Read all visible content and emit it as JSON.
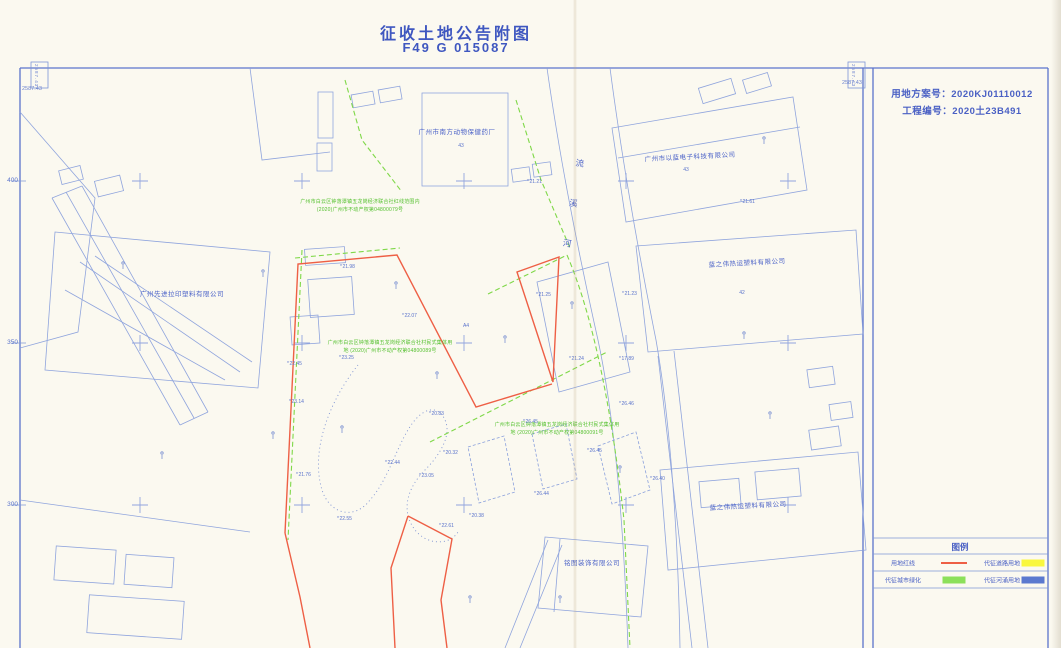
{
  "page": {
    "title_line1": "征收土地公告附图",
    "title_line2": "F49 G 015087"
  },
  "info_panel": {
    "line1": "用地方案号：2020KJ01110012",
    "line2": "工程编号：2020土23B491"
  },
  "legend": {
    "title": "图例",
    "items": [
      {
        "label": "用地红线",
        "symbol": "red-line",
        "color": "#ee5f45"
      },
      {
        "label": "代征道路用地",
        "symbol": "yellow-box",
        "color": "#f9f73e"
      },
      {
        "label": "代征城市绿化",
        "symbol": "green-box",
        "color": "#8ce05a"
      },
      {
        "label": "代征河涌用地",
        "symbol": "blue-box",
        "color": "#5b79cf"
      }
    ]
  },
  "frame": {
    "corner_coord_top_left": "2587.43",
    "corner_coord_top_right": "2587.43",
    "strip_left": "2587.43",
    "strip_right": "2587.43",
    "axis_labels": [
      "400",
      "350",
      "300"
    ]
  },
  "map": {
    "river_name": "流溪河",
    "companies": [
      "广州市南方动物保健药厂",
      "广州市以蓝电子科技有限公司",
      "蓝之伟热运塑料有限公司",
      "广州先进拉印塑料有限公司",
      "蓝之伟热运塑料有限公司",
      "铭图装饰有限公司"
    ],
    "codes": [
      "43",
      "43",
      "42",
      "A4"
    ],
    "annotations": {
      "a1": [
        "广州市白云区钟落潭镇五龙岗经济联合社红线范围内",
        "(2020)广州市不动产权第04800079号"
      ],
      "a2": [
        "广州市白云区钟落潭镇五龙岗经济联合社村民式集体用",
        "地 (2020)广州市不动产权第04800089号"
      ],
      "a3": [
        "广州市白云区钟落潭镇五龙岗经济联合社村民式集体用",
        "地 (2020)广州市不动产权第04800091号"
      ]
    },
    "spots": [
      "21.98",
      "21.21",
      "21.61",
      "21.25",
      "22.07",
      "23.25",
      "22.45",
      "23.14",
      "21.24",
      "17.89",
      "20.83",
      "26.45",
      "26.46",
      "20.32",
      "26.45",
      "23.05",
      "22.44",
      "22.55",
      "26.44",
      "20.38",
      "22.61",
      "21.76",
      "26.40",
      "21.23"
    ]
  },
  "colors": {
    "paper": "#fbf9f0",
    "line_blue": "#7e95d6",
    "frame_blue": "#5b74cc",
    "text_blue": "#4c63c8",
    "red_line": "#ee5f45",
    "green_line": "#7fd848",
    "green_text": "#54c02e",
    "legend_yellow": "#f9f73e",
    "legend_green": "#8ce05a",
    "legend_blue": "#5b79cf"
  }
}
